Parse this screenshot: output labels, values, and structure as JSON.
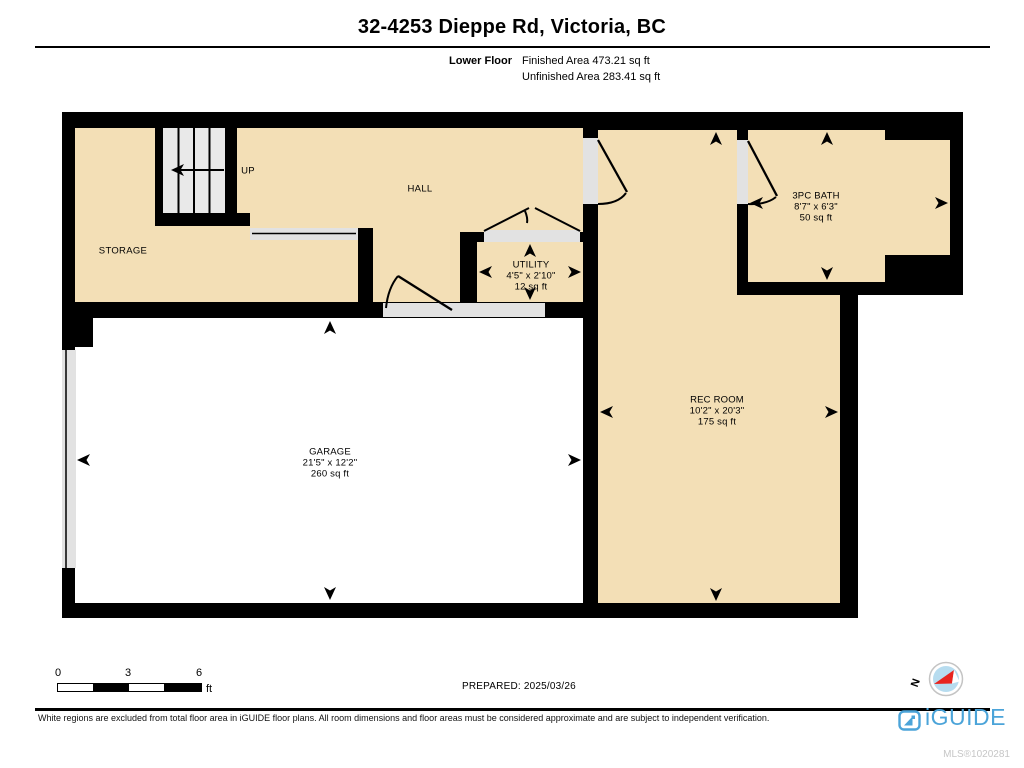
{
  "header": {
    "title": "32-4253 Dieppe Rd, Victoria, BC",
    "floor_label": "Lower Floor",
    "finished": "Finished Area 473.21 sq ft",
    "unfinished": "Unfinished Area 283.41 sq ft"
  },
  "rooms": {
    "storage": {
      "name": "STORAGE"
    },
    "stairs": {
      "label": "UP"
    },
    "hall": {
      "name": "HALL"
    },
    "utility": {
      "name": "UTILITY",
      "dims": "4'5\" x 2'10\"",
      "area": "12 sq ft"
    },
    "bath": {
      "name": "3PC BATH",
      "dims": "8'7\" x 6'3\"",
      "area": "50 sq ft"
    },
    "garage": {
      "name": "GARAGE",
      "dims": "21'5\" x 12'2\"",
      "area": "260 sq ft"
    },
    "rec_room": {
      "name": "REC ROOM",
      "dims": "10'2\" x 20'3\"",
      "area": "175 sq ft"
    }
  },
  "scale_bar": {
    "ticks": [
      "0",
      "3",
      "6"
    ],
    "unit": "ft"
  },
  "prepared": "PREPARED: 2025/03/26",
  "compass": {
    "north_label": "N"
  },
  "footer": {
    "disclaimer": "White regions are excluded from total floor area in iGUIDE floor plans. All room dimensions and floor areas must be considered approximate and are subject to independent verification.",
    "brand": "iGUIDE",
    "mls": "MLS®1020281"
  },
  "colors": {
    "floor_fill": "#F3DFB6",
    "wall": "#000000",
    "stair_fill": "#E9E9E9",
    "opening_fill": "#E2E2E2",
    "brand_blue": "#4BA4D9",
    "compass_blue": "#B7DCEF",
    "compass_red": "#E8251F",
    "mls_gray": "#C6C6C6"
  }
}
